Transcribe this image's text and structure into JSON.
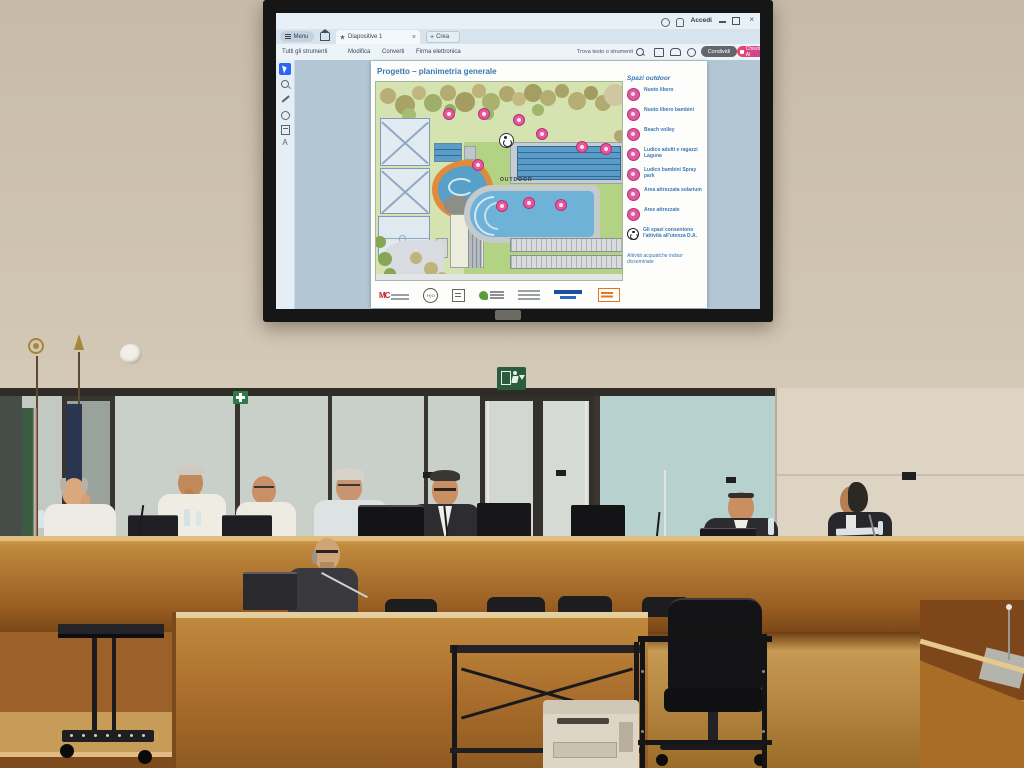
{
  "app": {
    "titlebar": {
      "signin_label": "Accedi"
    },
    "tabbar": {
      "menu_label": "Menu",
      "document_tab": "Diapositive 1",
      "create_tab": "Crea"
    },
    "menubar": {
      "items": [
        "Tutti gli strumenti",
        "Modifica",
        "Converti",
        "Firma elettronica"
      ]
    },
    "search_label": "Trova testo o strumenti",
    "share_label": "Condividi",
    "ai_label": "Chiedi all'Assistente AI",
    "colors": {
      "ai_pill": "#d84a6f",
      "share_pill": "#63666b",
      "accent_blue": "#2f66f0"
    }
  },
  "document": {
    "title": "Progetto – planimetria generale",
    "map_label_outdoor": "OUTDOOR",
    "legend": {
      "title": "Spazi outdoor",
      "items": [
        "Nuoto libero",
        "Nuoto libero bambini",
        "Beach volley",
        "Ludico adulti e ragazzi Laguna",
        "Ludico bambini Spray park",
        "Area attrezzata solarium",
        "Aree attrezzate",
        "Gli spazi consentono l'attività all'utenza D.A."
      ],
      "note": "Attività acquatiche indoor disseminate"
    },
    "logos": [
      "MC",
      "H₂O",
      "",
      "",
      "",
      "",
      ""
    ]
  },
  "room": {
    "signs": {
      "exit": "exit-running-man-down-arrow",
      "first_aid": "green-cross"
    },
    "flags": [
      "italy",
      "european-union"
    ]
  }
}
